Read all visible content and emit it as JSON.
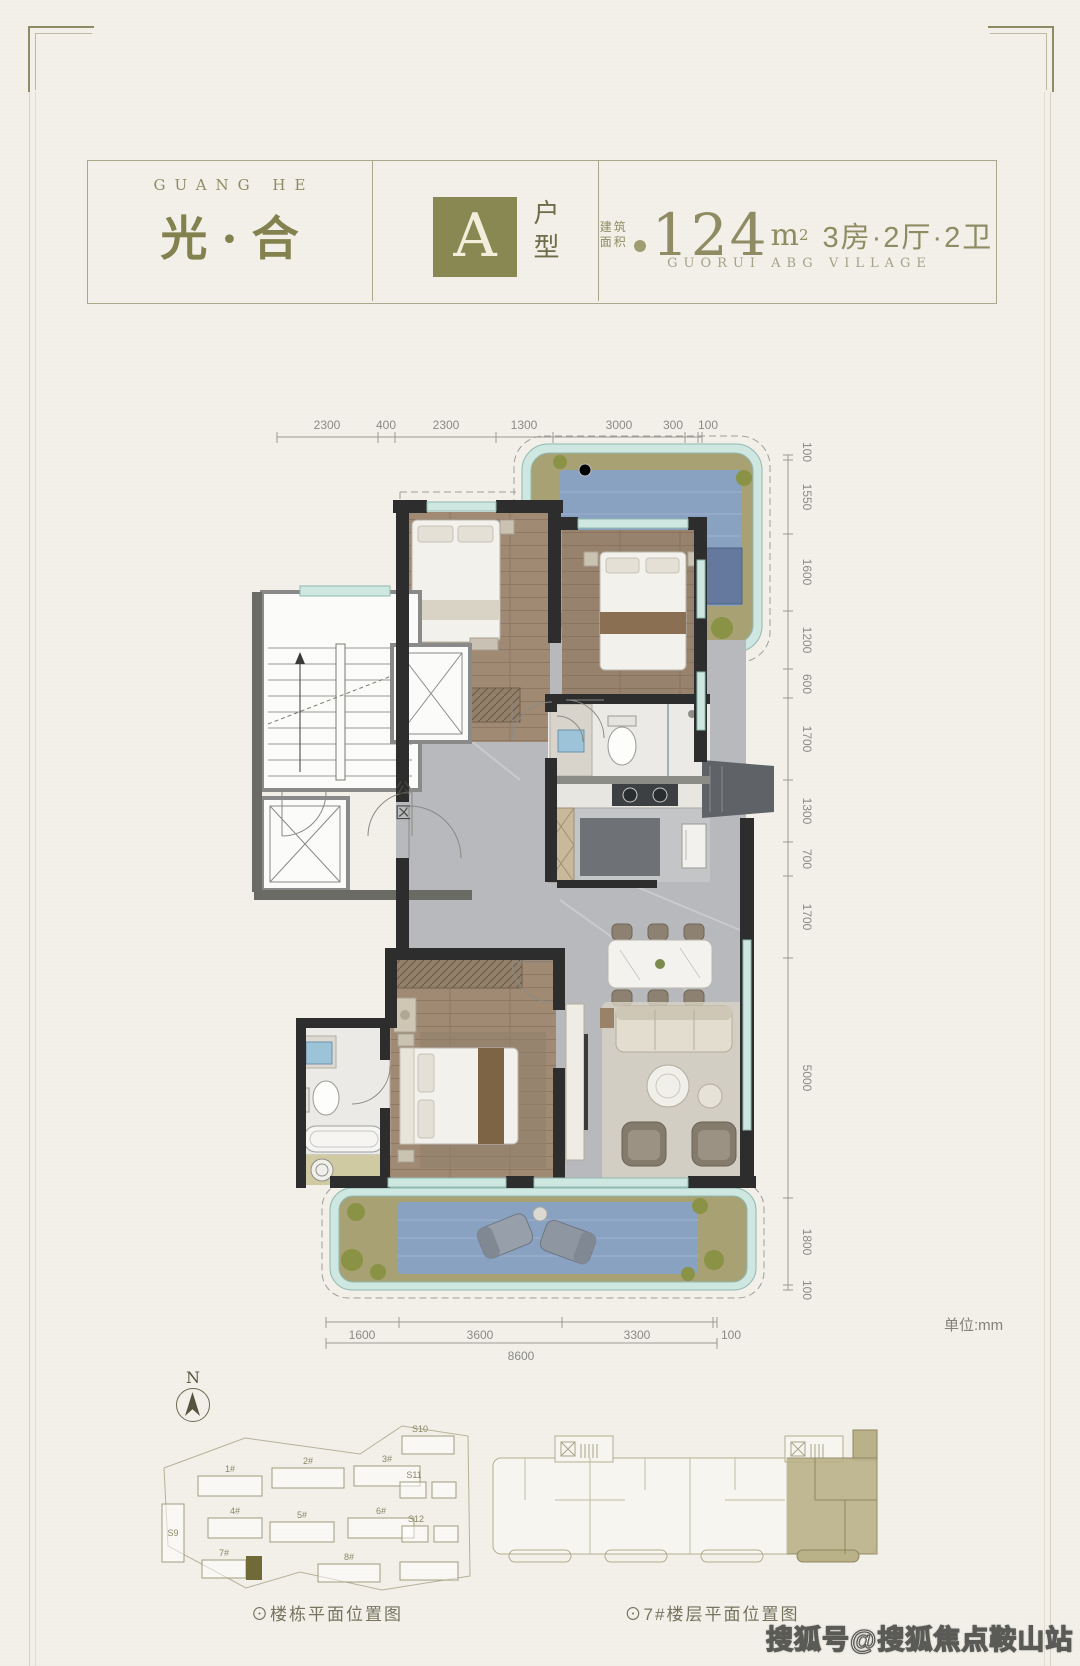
{
  "header": {
    "brand_en": "GUANG HE",
    "brand_cn": "光·合",
    "unit_letter": "A",
    "unit_type": "户型",
    "area_label_1": "建筑",
    "area_label_2": "面积",
    "area_number": "124",
    "area_unit_base": "m",
    "area_unit_sup": "2",
    "layout_text": "3房·2厅·2卫",
    "project_en": "GUORUI ABG VILLAGE"
  },
  "plan": {
    "public_area": "公区",
    "unit_note": "单位:mm",
    "dims_top": [
      "2300",
      "400",
      "2300",
      "1300",
      "3000",
      "300",
      "100"
    ],
    "dims_right": [
      "100",
      "1550",
      "1600",
      "1200",
      "600",
      "1700",
      "1300",
      "700",
      "1700",
      "5000",
      "1800",
      "100"
    ],
    "dims_bottom": [
      "1600",
      "3600",
      "3300",
      "100"
    ],
    "dim_total": "8600"
  },
  "site": {
    "north": "N",
    "caption": "⊙楼栋平面位置图",
    "buildings": [
      "1#",
      "2#",
      "3#",
      "4#",
      "5#",
      "6#",
      "7#",
      "8#",
      "S9",
      "S10",
      "S11",
      "S12"
    ]
  },
  "floor": {
    "caption": "⊙7#楼层平面位置图"
  },
  "watermark": "搜狐号@搜狐焦点鞍山站",
  "colors": {
    "brand_olive": "#8a8852",
    "wall_black": "#2d2d2d",
    "balcony_teal": "#cfe7e1",
    "mat_blue": "#8aa2c2",
    "wood": "#a08a74",
    "marble": "#b7b9bc"
  }
}
